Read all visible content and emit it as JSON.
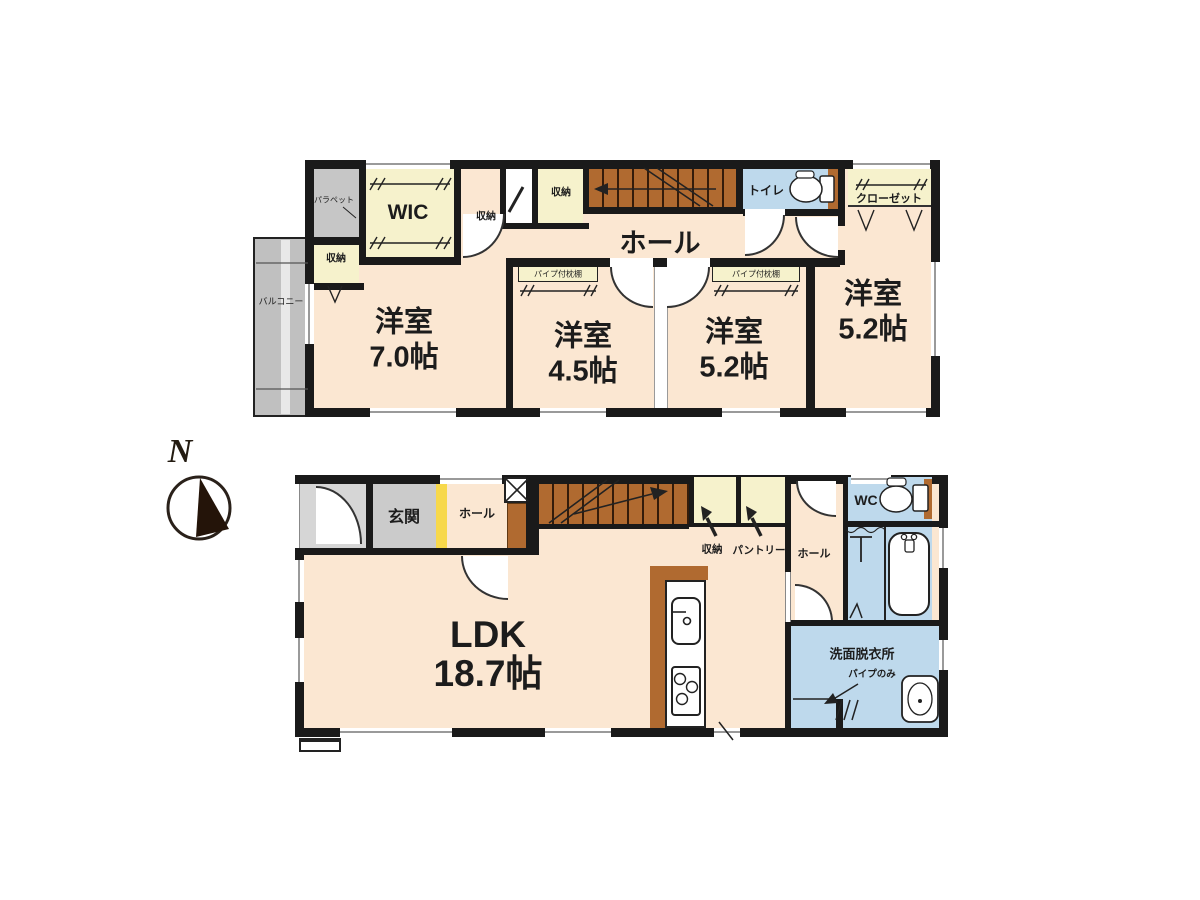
{
  "compass": {
    "north": "N"
  },
  "terms": {
    "storage": "収納",
    "hall": "ホール",
    "pipe_shelf": "パイプ付枕棚",
    "wic": "WIC",
    "toilet": "トイレ",
    "closet": "クローゼット",
    "parapet": "パラペット",
    "balcony": "バルコニー",
    "entrance": "玄関",
    "wc": "WC",
    "pantry": "パントリー",
    "washroom": "洗面脱衣所",
    "pipe_only": "パイプのみ"
  },
  "floor2": {
    "rooms": [
      {
        "name": "洋室",
        "size": "7.0帖"
      },
      {
        "name": "洋室",
        "size": "4.5帖"
      },
      {
        "name": "洋室",
        "size": "5.2帖"
      },
      {
        "name": "洋室",
        "size": "5.2帖"
      }
    ]
  },
  "floor1": {
    "ldk": {
      "name": "LDK",
      "size": "18.7帖"
    }
  },
  "colors": {
    "wall": "#1a1a1a",
    "room_fill": "#fbe7d2",
    "closet_fill": "#f6f2cc",
    "wet_fill": "#bed9ec",
    "wood": "#b06a30",
    "gray": "#c6c6c6",
    "entrance_yellow": "#f7d84b",
    "background": "#ffffff"
  }
}
